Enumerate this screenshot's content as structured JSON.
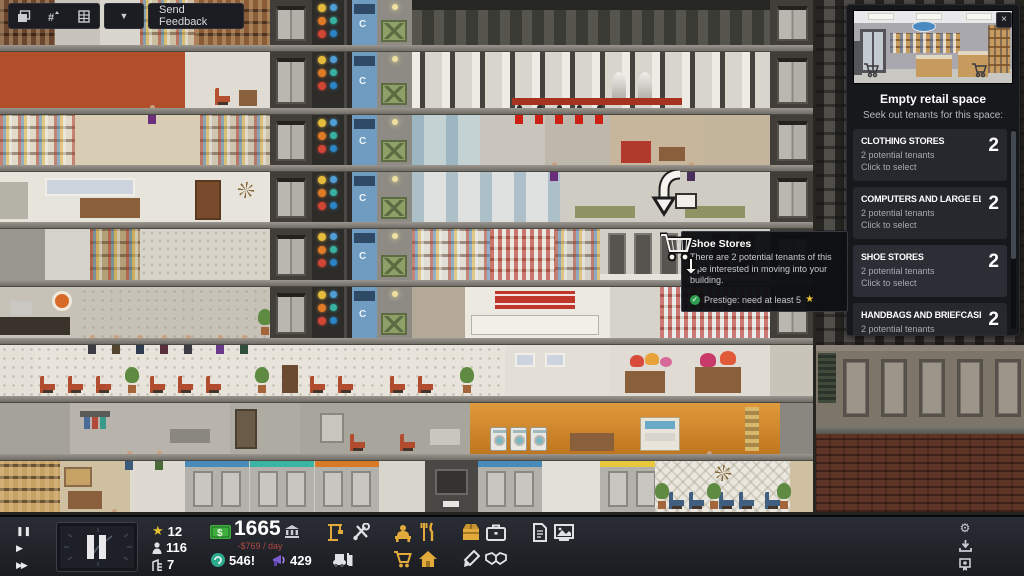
{
  "top_toolbar": {
    "send_feedback_label": "Send Feedback",
    "dropdown_glyph": "▼"
  },
  "panel": {
    "title": "Empty retail space",
    "subtitle": "Seek out tenants for this space:",
    "close_glyph": "×",
    "tenants": [
      {
        "name": "CLOTHING STORES",
        "count": "2",
        "detail": "2 potential tenants",
        "action": "Click to select"
      },
      {
        "name": "COMPUTERS AND LARGE ELECTRONICS",
        "count": "2",
        "detail": "2 potential tenants",
        "action": "Click to select"
      },
      {
        "name": "SHOE STORES",
        "count": "2",
        "detail": "2 potential tenants",
        "action": "Click to select"
      },
      {
        "name": "HANDBAGS AND BRIEFCASES",
        "count": "2",
        "detail": "2 potential tenants",
        "action": "Click to select"
      }
    ]
  },
  "tooltip": {
    "title": "Shoe Stores",
    "body": "There are 2 potential tenants of this type interested in moving into your building.",
    "check_glyph": "✓",
    "requirement": "Prestige: need at least 5",
    "star_glyph": "★"
  },
  "status_bar": {
    "speed": {
      "pause_glyph": "❚❚",
      "play_glyph": "▶",
      "ffwd_glyph": "▶▶"
    },
    "stats": {
      "prestige_star_glyph": "★",
      "prestige": "12",
      "population": "116",
      "floors": "7"
    },
    "money": {
      "cash": "1665",
      "daily_change": "-$769 / day"
    },
    "resources": {
      "influence": "546!",
      "buzz": "429"
    },
    "settings_glyph": "⚙"
  },
  "building_art": {
    "conduit_label": "C"
  },
  "colors": {
    "accent_yellow": "#e2a93b",
    "cash_green": "#3fae3f",
    "negative_red": "#b04a42",
    "influence_teal": "#2fa98c",
    "buzz_purple": "#7a5bd0",
    "star_yellow": "#e9c232"
  }
}
